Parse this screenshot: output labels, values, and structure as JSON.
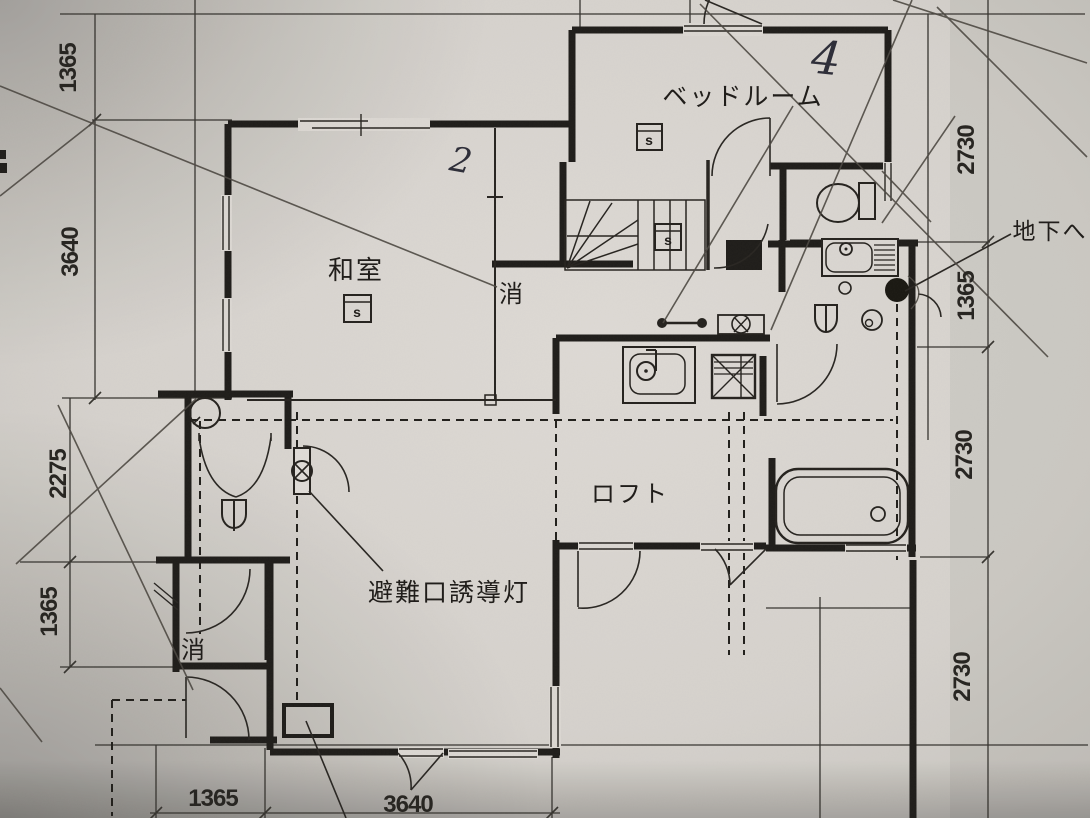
{
  "rooms": {
    "bedroom": "ベッドルーム",
    "japanese_room": "和室",
    "loft": "ロフト"
  },
  "labels": {
    "to_basement": "地下へ",
    "exit_guide_light": "避難口誘導灯",
    "fire_ext_upper": "消",
    "fire_ext_lower": "消",
    "detector": "s"
  },
  "handwriting": {
    "floor_note": "4",
    "room_note": "2"
  },
  "dimensions": {
    "left": [
      "1365",
      "3640",
      "2275",
      "1365"
    ],
    "right": [
      "2730",
      "1365",
      "2730",
      "2730"
    ],
    "bottom": [
      "1365",
      "3640"
    ]
  },
  "colors": {
    "paper": "#d8d4cd",
    "ink": "#1c1a17",
    "pencil": "#45413b",
    "pen": "#2a2a36"
  }
}
